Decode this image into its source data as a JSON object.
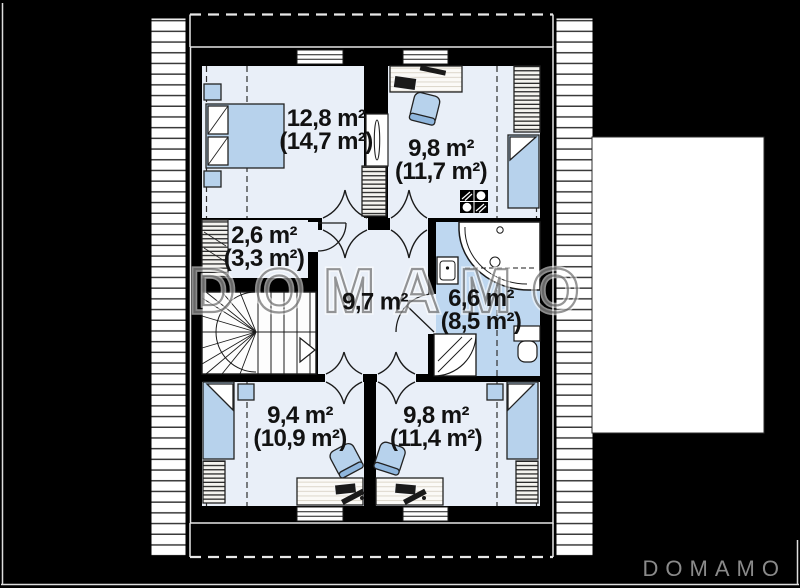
{
  "brand": {
    "watermark": "DOMAMO",
    "logo": "DOMAMO"
  },
  "rooms": {
    "bedroom_top_left": {
      "area": "12,8 m²",
      "total": "(14,7 m²)"
    },
    "room_top_right": {
      "area": "9,8 m²",
      "total": "(11,7 m²)"
    },
    "closet": {
      "area": "2,6 m²",
      "total": "(3,3 m²)"
    },
    "hall": {
      "area": "9,7 m²"
    },
    "bathroom": {
      "area": "6,6 m²",
      "total": "(8,5 m²)"
    },
    "bedroom_bottom_left": {
      "area": "9,4 m²",
      "total": "(10,9 m²)"
    },
    "bedroom_bottom_right": {
      "area": "9,8 m²",
      "total": "(11,4 m²)"
    }
  },
  "colors": {
    "background": "#000000",
    "room_fill": "#e9eff8",
    "bathroom_fill": "#bed7f0",
    "furniture_blue": "#b7d2ec",
    "watermark_gray": "#565656",
    "logo_gray": "#8a8a8a"
  }
}
